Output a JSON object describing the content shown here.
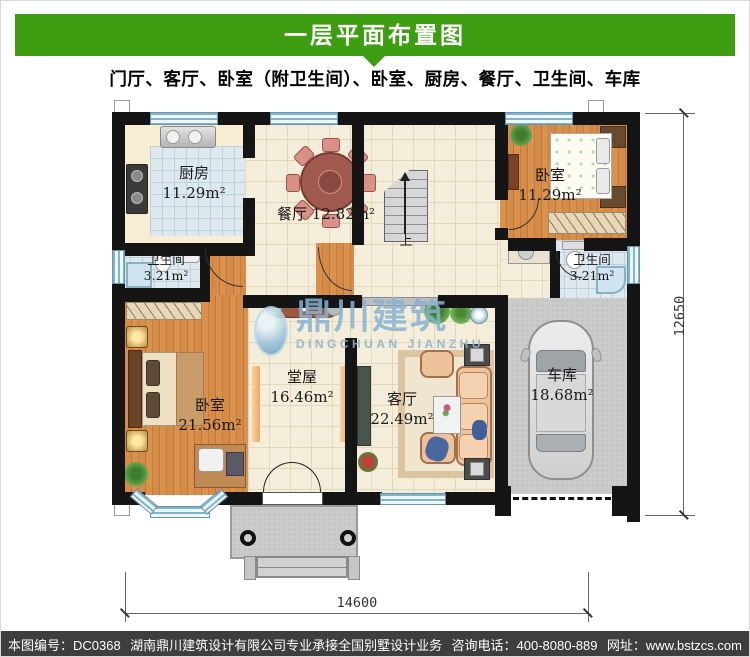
{
  "header": {
    "title": "一层平面布置图",
    "subtitle": "门厅、客厅、卧室（附卫生间）、卧室、厨房、餐厅、卫生间、车库"
  },
  "rooms": {
    "kitchen": {
      "name": "厨房",
      "area": "11.29m²"
    },
    "dining": {
      "name": "餐厅",
      "area": "12.82m²"
    },
    "bath_left": {
      "name": "卫生间",
      "area": "3.21m²"
    },
    "bedroom_top": {
      "name": "卧室",
      "area": "11.29m²"
    },
    "bath_right": {
      "name": "卫生间",
      "area": "3.21m²"
    },
    "bedroom_left": {
      "name": "卧室",
      "area": "21.56m²"
    },
    "hall": {
      "name": "堂屋",
      "area": "16.46m²"
    },
    "living": {
      "name": "客厅",
      "area": "22.49m²"
    },
    "garage": {
      "name": "车库",
      "area": "18.68m²"
    }
  },
  "stairs": {
    "up_label": "上"
  },
  "watermark": {
    "name_cn": "鼎川建筑",
    "name_en": "DINGCHUAN JIANZHU"
  },
  "dimensions": {
    "width_mm": "14600",
    "height_mm": "12650"
  },
  "footer": {
    "drawing_no": "本图编号：DC0368",
    "company": "湖南鼎川建筑设计有限公司专业承接全国别墅设计业务",
    "phone": "咨询电话：400-8080-889",
    "website": "网址：www.bstzcs.com"
  },
  "colors": {
    "banner_green": "#3f9d11",
    "footer_gray": "#3e3e3e",
    "watermark_blue": "#87b2d0"
  }
}
